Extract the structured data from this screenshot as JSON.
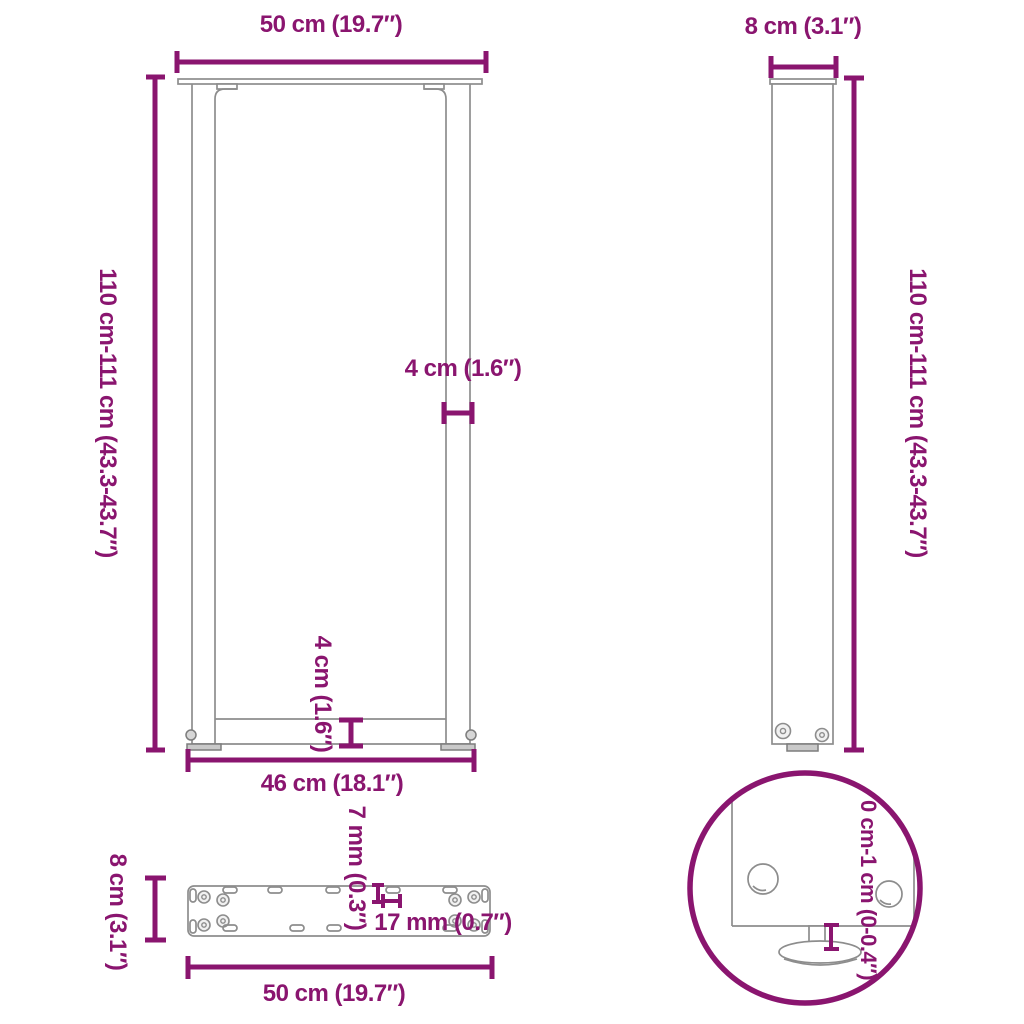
{
  "diagram": {
    "colors": {
      "accent": "#8a156f",
      "structure": "#8d8d8d"
    },
    "front_view": {
      "top_width": "50 cm (19.7″)",
      "height": "110 cm-111 cm (43.3-43.7″)",
      "tube_width": "4 cm (1.6″)",
      "crossbar_height": "4 cm (1.6″)",
      "inner_width": "46 cm (18.1″)"
    },
    "side_view": {
      "depth": "8 cm (3.1″)",
      "height": "110 cm-111 cm (43.3-43.7″)"
    },
    "plate_view": {
      "depth": "8 cm (3.1″)",
      "width": "50 cm (19.7″)",
      "slot_width": "7 mm (0.3″)",
      "slot_length": "17 mm (0.7″)"
    },
    "detail_view": {
      "height_adjustment": "0 cm-1 cm (0-0.4″)"
    }
  }
}
